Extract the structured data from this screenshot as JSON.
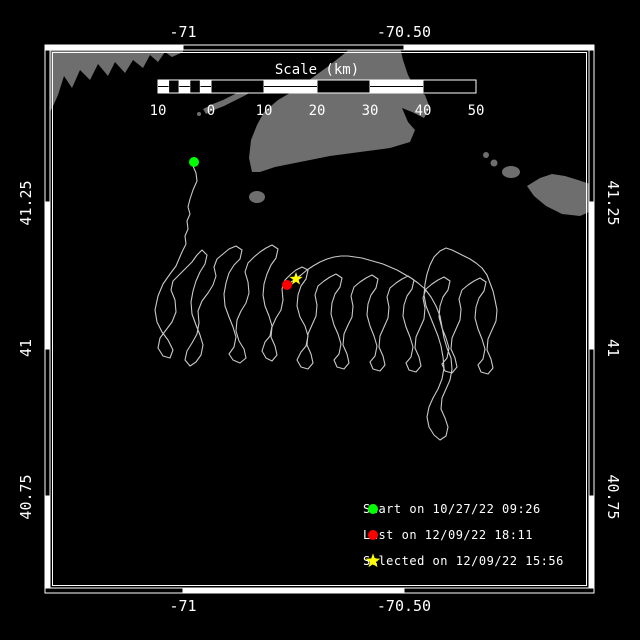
{
  "frame": {
    "lon_ticks": [
      {
        "label": "-71"
      },
      {
        "label": "-70.50"
      }
    ],
    "lat_ticks": [
      {
        "label": "41.25"
      },
      {
        "label": "41"
      },
      {
        "label": "40.75"
      }
    ]
  },
  "scalebar": {
    "title": "Scale (km)",
    "tick_labels": [
      "10",
      "0",
      "10",
      "20",
      "30",
      "40",
      "50"
    ]
  },
  "legend": {
    "items": [
      {
        "marker": "start-dot",
        "label": "Start on 10/27/22 09:26"
      },
      {
        "marker": "last-dot",
        "label": "Last on 12/09/22 18:11"
      },
      {
        "marker": "selected-star",
        "label": "Selected on 12/09/22 15:56"
      }
    ]
  },
  "colors": {
    "background": "#000000",
    "land": "#6e6e6e",
    "track": "#c9c9c9",
    "frame": "#ffffff",
    "text": "#ffffff",
    "start_marker": "#00ff00",
    "last_marker": "#ff0000",
    "selected_marker": "#ffff00"
  }
}
